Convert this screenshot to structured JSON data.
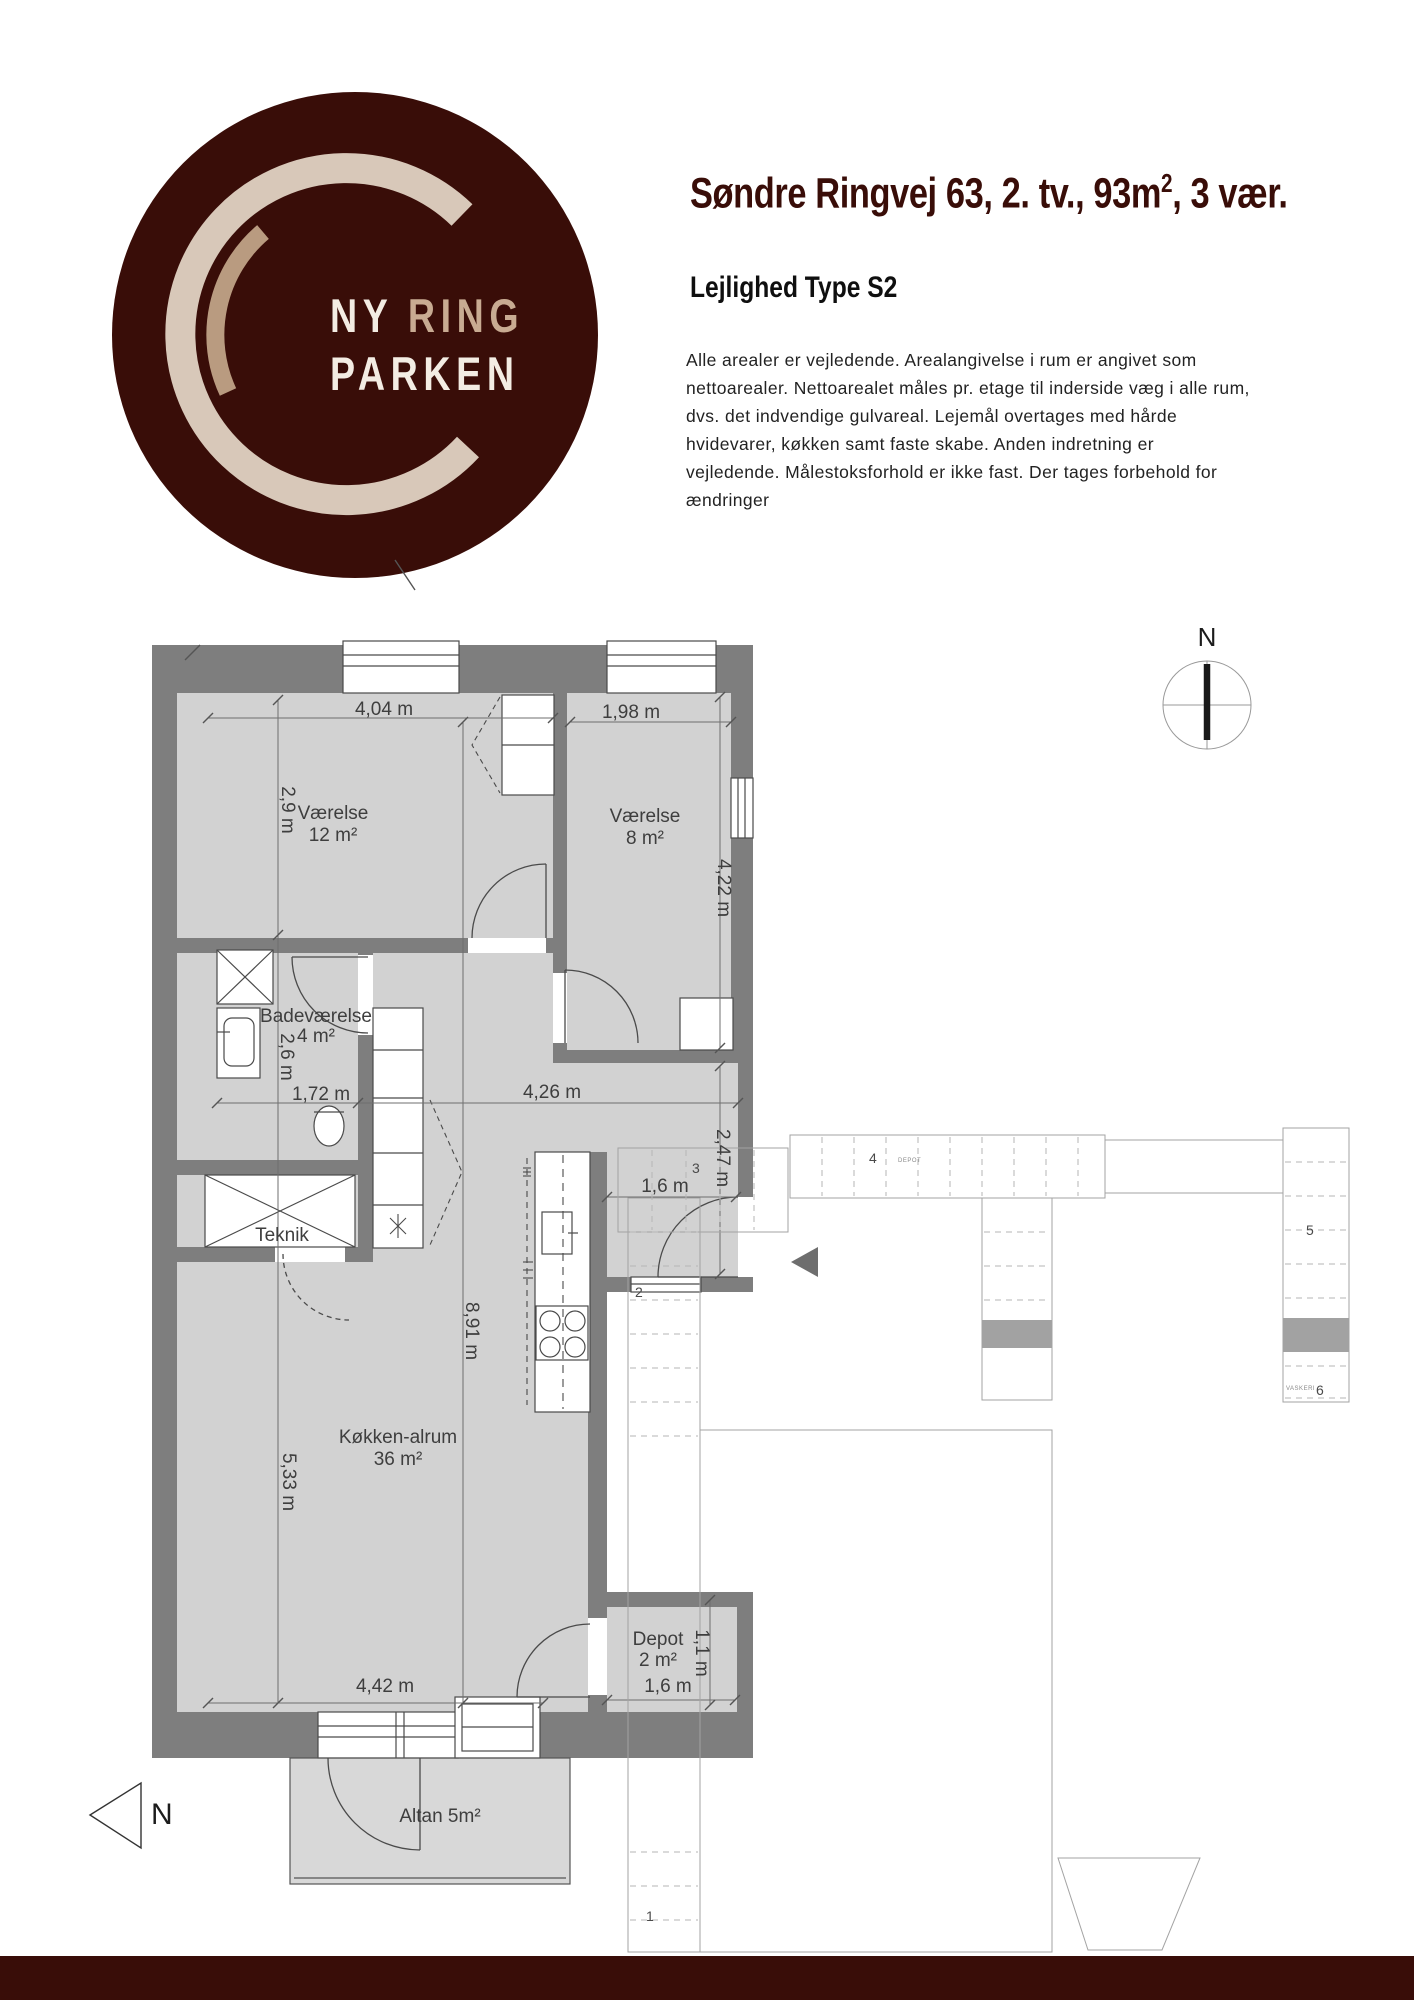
{
  "colors": {
    "brand_maroon": "#390d08",
    "wall_gray": "#7e7e7e",
    "floor_gray": "#d2d2d2",
    "logo_ring_light": "#d8c8b9",
    "logo_ring_tan": "#b99b80",
    "site_gray": "#a2a2a2"
  },
  "logo": {
    "word1": "NY",
    "word2": "RING",
    "word3": "PARKEN"
  },
  "header": {
    "title_prefix": "Søndre Ringvej 63, 2. tv., 93m",
    "title_sup": "2",
    "title_suffix": ", 3 vær.",
    "subtitle": "Lejlighed Type S2",
    "description": "Alle arealer er vejledende. Arealangivelse i rum er angivet som nettoarealer. Nettoarealet måles pr. etage til inderside væg i alle rum, dvs. det indvendige gulvareal. Lejemål overtages med hårde hvidevarer, køkken samt faste skabe. Anden indretning er vejledende. Målestoksforhold er ikke fast. Der tages forbehold for ændringer"
  },
  "compass": {
    "label": "N"
  },
  "north_arrow": {
    "label": "N"
  },
  "floorplan": {
    "rooms": {
      "v12": {
        "name": "Værelse",
        "area": "12 m²"
      },
      "v8": {
        "name": "Værelse",
        "area": "8 m²"
      },
      "bad": {
        "name": "Badeværelse",
        "area": "4 m²"
      },
      "teknik": {
        "name": "Teknik"
      },
      "kokken": {
        "name": "Køkken-alrum",
        "area": "36 m²"
      },
      "depot": {
        "name": "Depot",
        "area": "2 m²"
      },
      "altan": {
        "name": "Altan 5m²"
      }
    },
    "dims": {
      "d404": "4,04 m",
      "d198": "1,98 m",
      "d29": "2,9 m",
      "d422": "4,22 m",
      "d26": "2,6 m",
      "d172": "1,72 m",
      "d426": "4,26 m",
      "d247": "2,47 m",
      "d16hall": "1,6 m",
      "d891": "8,91 m",
      "d533": "5,33 m",
      "d442": "4,42 m",
      "d16depot": "1,6 m",
      "d11": "1,1 m"
    }
  },
  "siteplan": {
    "n1": "1",
    "n2": "2",
    "n3": "3",
    "n4": "4",
    "n5": "5",
    "n6": "6",
    "tiny1": "DEPOT",
    "tiny2": "VASKERI"
  }
}
